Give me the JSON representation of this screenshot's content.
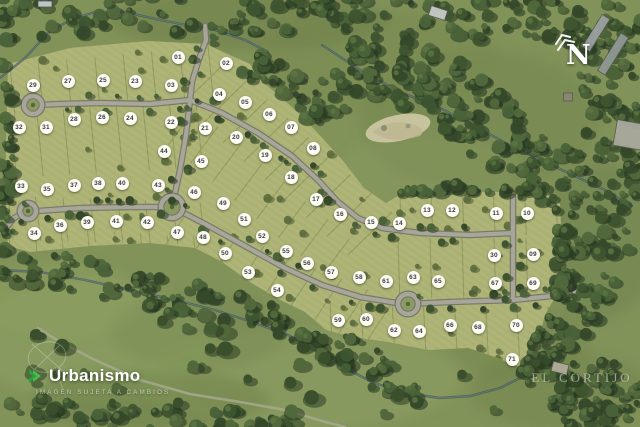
{
  "map": {
    "compass": {
      "label": "N"
    },
    "watermark": {
      "name": "Urbanismo",
      "disclaimer": "IMAGEN SUJETA A CAMBIOS"
    },
    "place": {
      "label": "EL CORTIJO"
    },
    "lots": [
      {
        "n": "01",
        "x": 178,
        "y": 57
      },
      {
        "n": "02",
        "x": 226,
        "y": 63
      },
      {
        "n": "03",
        "x": 171,
        "y": 85
      },
      {
        "n": "04",
        "x": 219,
        "y": 94
      },
      {
        "n": "05",
        "x": 245,
        "y": 102
      },
      {
        "n": "06",
        "x": 269,
        "y": 114
      },
      {
        "n": "07",
        "x": 291,
        "y": 127
      },
      {
        "n": "08",
        "x": 313,
        "y": 148
      },
      {
        "n": "09",
        "x": 533,
        "y": 254
      },
      {
        "n": "10",
        "x": 527,
        "y": 213
      },
      {
        "n": "11",
        "x": 496,
        "y": 213
      },
      {
        "n": "12",
        "x": 452,
        "y": 210
      },
      {
        "n": "13",
        "x": 427,
        "y": 210
      },
      {
        "n": "14",
        "x": 399,
        "y": 223
      },
      {
        "n": "15",
        "x": 371,
        "y": 222
      },
      {
        "n": "16",
        "x": 340,
        "y": 214
      },
      {
        "n": "17",
        "x": 316,
        "y": 199
      },
      {
        "n": "18",
        "x": 291,
        "y": 177
      },
      {
        "n": "19",
        "x": 265,
        "y": 155
      },
      {
        "n": "20",
        "x": 236,
        "y": 137
      },
      {
        "n": "21",
        "x": 205,
        "y": 128
      },
      {
        "n": "22",
        "x": 171,
        "y": 122
      },
      {
        "n": "23",
        "x": 135,
        "y": 81
      },
      {
        "n": "24",
        "x": 130,
        "y": 118
      },
      {
        "n": "25",
        "x": 103,
        "y": 80
      },
      {
        "n": "26",
        "x": 102,
        "y": 117
      },
      {
        "n": "27",
        "x": 68,
        "y": 81
      },
      {
        "n": "28",
        "x": 74,
        "y": 119
      },
      {
        "n": "29",
        "x": 33,
        "y": 85
      },
      {
        "n": "30",
        "x": 494,
        "y": 255
      },
      {
        "n": "31",
        "x": 46,
        "y": 127
      },
      {
        "n": "32",
        "x": 19,
        "y": 127
      },
      {
        "n": "33",
        "x": 21,
        "y": 186
      },
      {
        "n": "34",
        "x": 34,
        "y": 233
      },
      {
        "n": "35",
        "x": 47,
        "y": 189
      },
      {
        "n": "36",
        "x": 60,
        "y": 225
      },
      {
        "n": "37",
        "x": 74,
        "y": 185
      },
      {
        "n": "38",
        "x": 98,
        "y": 183
      },
      {
        "n": "39",
        "x": 87,
        "y": 222
      },
      {
        "n": "40",
        "x": 122,
        "y": 183
      },
      {
        "n": "41",
        "x": 116,
        "y": 221
      },
      {
        "n": "42",
        "x": 147,
        "y": 222
      },
      {
        "n": "43",
        "x": 158,
        "y": 185
      },
      {
        "n": "44",
        "x": 164,
        "y": 151
      },
      {
        "n": "45",
        "x": 201,
        "y": 161
      },
      {
        "n": "46",
        "x": 194,
        "y": 192
      },
      {
        "n": "47",
        "x": 177,
        "y": 232
      },
      {
        "n": "48",
        "x": 203,
        "y": 237
      },
      {
        "n": "49",
        "x": 223,
        "y": 203
      },
      {
        "n": "50",
        "x": 225,
        "y": 253
      },
      {
        "n": "51",
        "x": 244,
        "y": 219
      },
      {
        "n": "52",
        "x": 262,
        "y": 236
      },
      {
        "n": "53",
        "x": 248,
        "y": 272
      },
      {
        "n": "54",
        "x": 277,
        "y": 290
      },
      {
        "n": "55",
        "x": 286,
        "y": 251
      },
      {
        "n": "56",
        "x": 307,
        "y": 263
      },
      {
        "n": "57",
        "x": 331,
        "y": 272
      },
      {
        "n": "58",
        "x": 359,
        "y": 277
      },
      {
        "n": "59",
        "x": 338,
        "y": 320
      },
      {
        "n": "60",
        "x": 366,
        "y": 319
      },
      {
        "n": "61",
        "x": 386,
        "y": 281
      },
      {
        "n": "62",
        "x": 394,
        "y": 330
      },
      {
        "n": "63",
        "x": 413,
        "y": 277
      },
      {
        "n": "64",
        "x": 419,
        "y": 331
      },
      {
        "n": "65",
        "x": 438,
        "y": 281
      },
      {
        "n": "66",
        "x": 450,
        "y": 325
      },
      {
        "n": "67",
        "x": 495,
        "y": 283
      },
      {
        "n": "68",
        "x": 478,
        "y": 327
      },
      {
        "n": "69",
        "x": 533,
        "y": 283
      },
      {
        "n": "70",
        "x": 516,
        "y": 325
      },
      {
        "n": "71",
        "x": 512,
        "y": 359
      }
    ],
    "colors": {
      "pasture": "#82935a",
      "lot": "#abb172",
      "lot_line": "#878f54",
      "road": "#a8a599",
      "road_casing": "#75786a",
      "forest_dark": "#35492a",
      "creek": "#3e5152",
      "badge_bg": "#fdfdf6",
      "logo_green_light": "#4CBB4F",
      "logo_green_dark": "#2F9E44"
    }
  }
}
